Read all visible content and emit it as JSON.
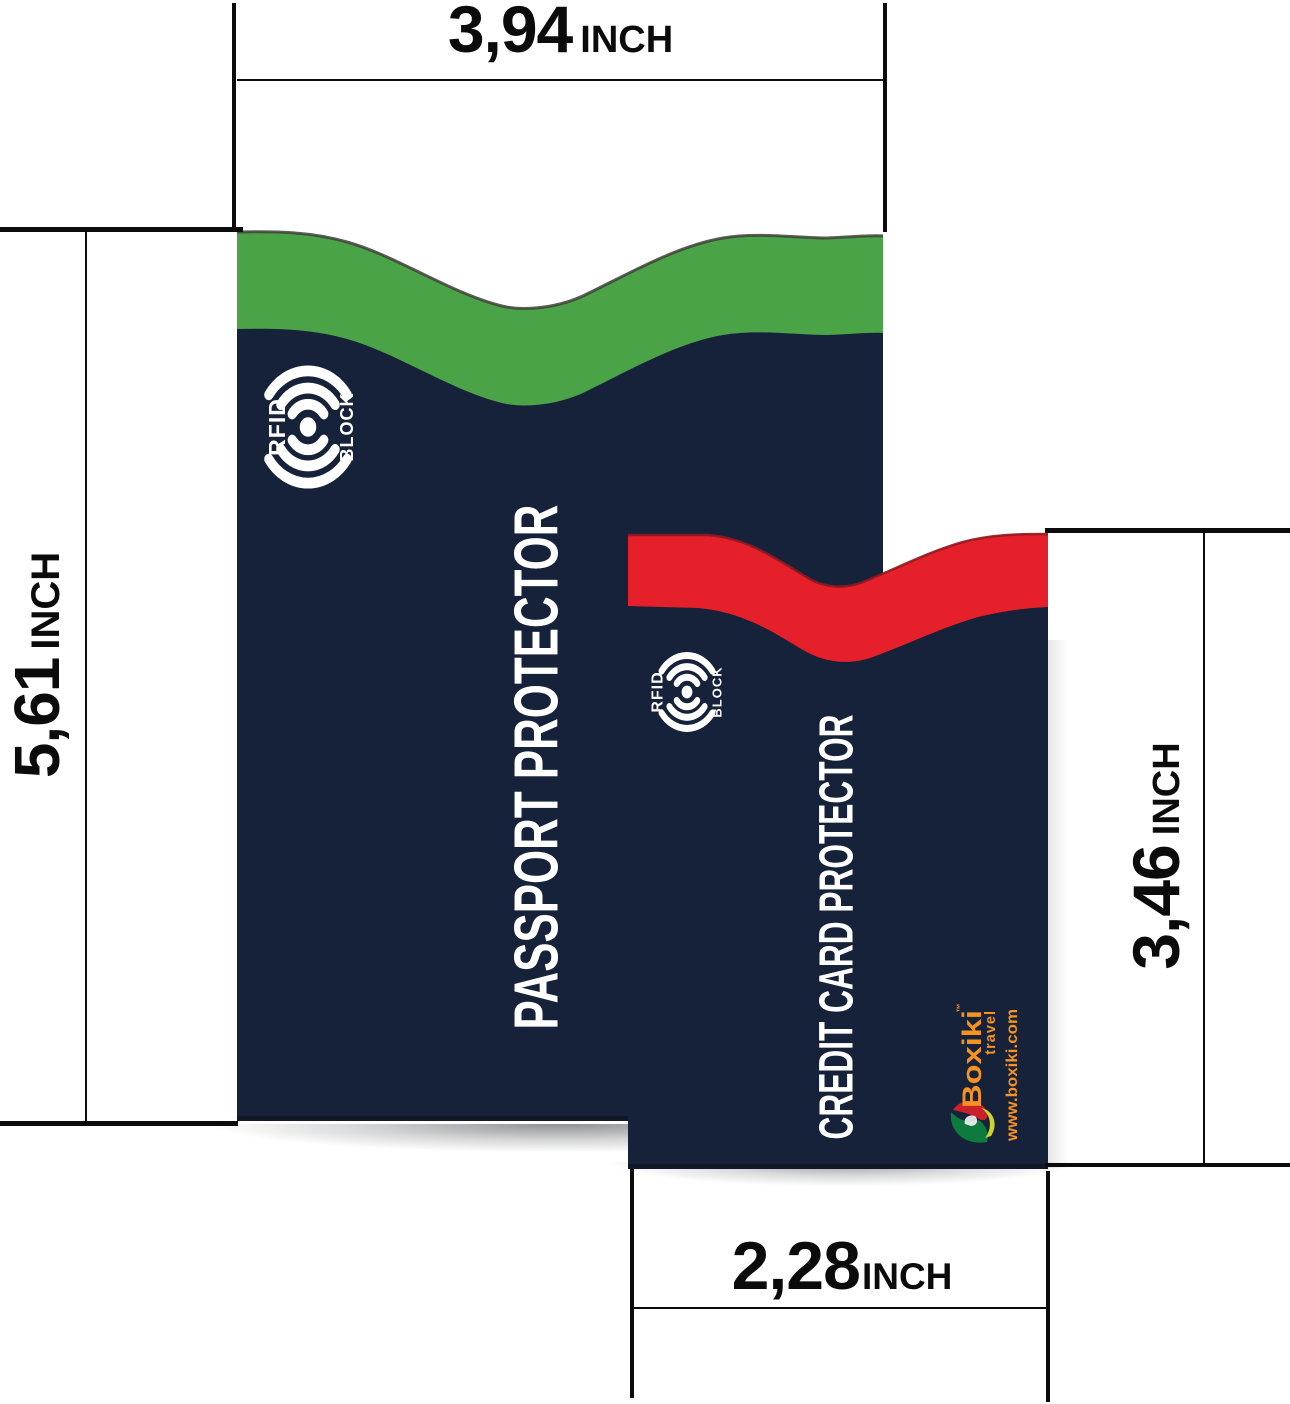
{
  "scene": {
    "background": "#ffffff",
    "line_color": "#0c0c0c",
    "label_color": "#0b0b0b"
  },
  "rfid_badge": {
    "left_text": "RFID",
    "right_text": "BLOCK"
  },
  "passport_sleeve": {
    "label": "PASSPORT PROTECTOR",
    "band_color": "#4aa347",
    "body_color": "#16213a"
  },
  "credit_sleeve": {
    "label": "CREDIT CARD PROTECTOR",
    "band_color": "#e5202a",
    "body_color": "#16213a",
    "brand": {
      "name": "Boxiki",
      "trademark": "™",
      "tagline": "travel",
      "website": "www.boxiki.com",
      "color": "#f6921e"
    }
  },
  "dimensions": {
    "top": {
      "value": "3,94",
      "unit": "INCH"
    },
    "left": {
      "value": "5,61",
      "unit": "INCH"
    },
    "right": {
      "value": "3,46",
      "unit": "INCH"
    },
    "bottom": {
      "value": "2,28",
      "unit": "INCH"
    }
  }
}
